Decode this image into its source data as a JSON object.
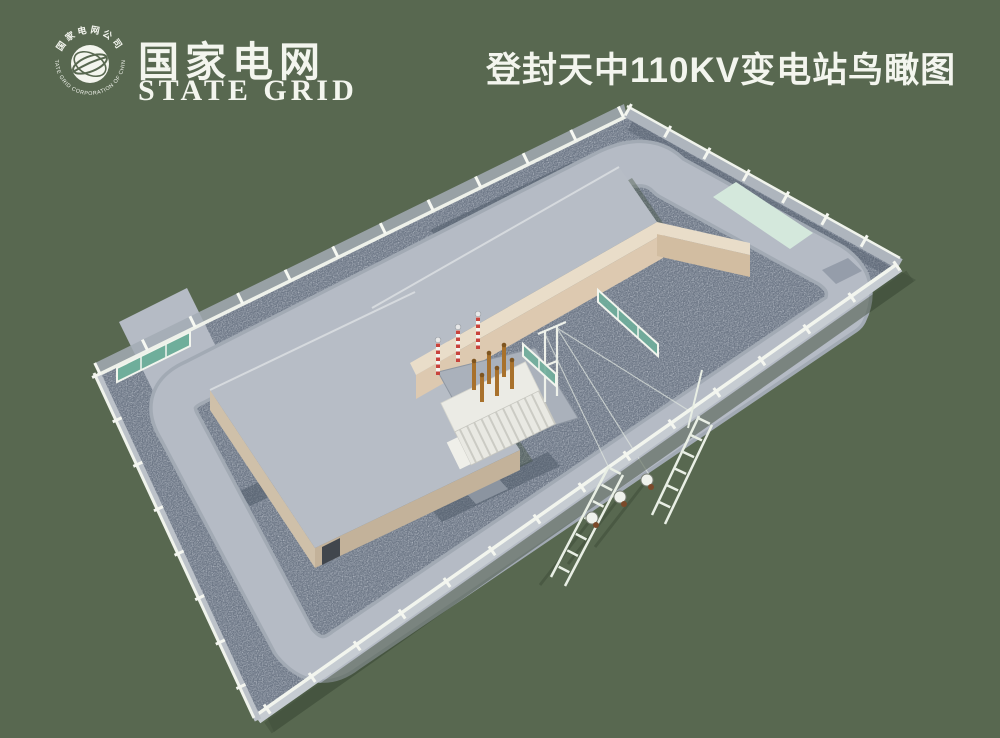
{
  "header": {
    "title": "登封天中110KV变电站鸟瞰图",
    "logo": {
      "name_cn": "国家电网",
      "name_en": "STATE GRID",
      "emblem_top_text": "国家电网公司",
      "emblem_ring_text": "STATE GRID CORPORATION OF CHINA"
    }
  },
  "scene": {
    "subject": "Bird's-eye 3D rendering of the Dengfeng Tianzhong 110KV substation",
    "features": [
      "perimeter-wall",
      "ring-road",
      "gravel-yard",
      "main-building",
      "fire-wall",
      "main-transformer",
      "lightning-arresters",
      "gantry",
      "safety-fences",
      "entrance-gate",
      "terminal-poles",
      "overhead-wires"
    ]
  },
  "colors": {
    "bg": "#586850",
    "text": "#f3f5ee",
    "gravel": "#6e7887",
    "gravel_dark": "#4c5766",
    "road": "#b5bbc5",
    "roof": "#b7bdc6",
    "wall_tan": "#ddc9b0",
    "wall_tan_top": "#e9ddc9",
    "building_wall": "#cfc0a9",
    "teal": "#6fae9b",
    "mint": "#d4e8dc",
    "fence_white": "#f2f5ee",
    "stone": "#aeb5bd",
    "shadow": "#3f4e3a",
    "pad": "#aab1bb",
    "bushing": "#a8712c",
    "arrester_red": "#c8433c",
    "transformer_body": "#ebebe5"
  }
}
